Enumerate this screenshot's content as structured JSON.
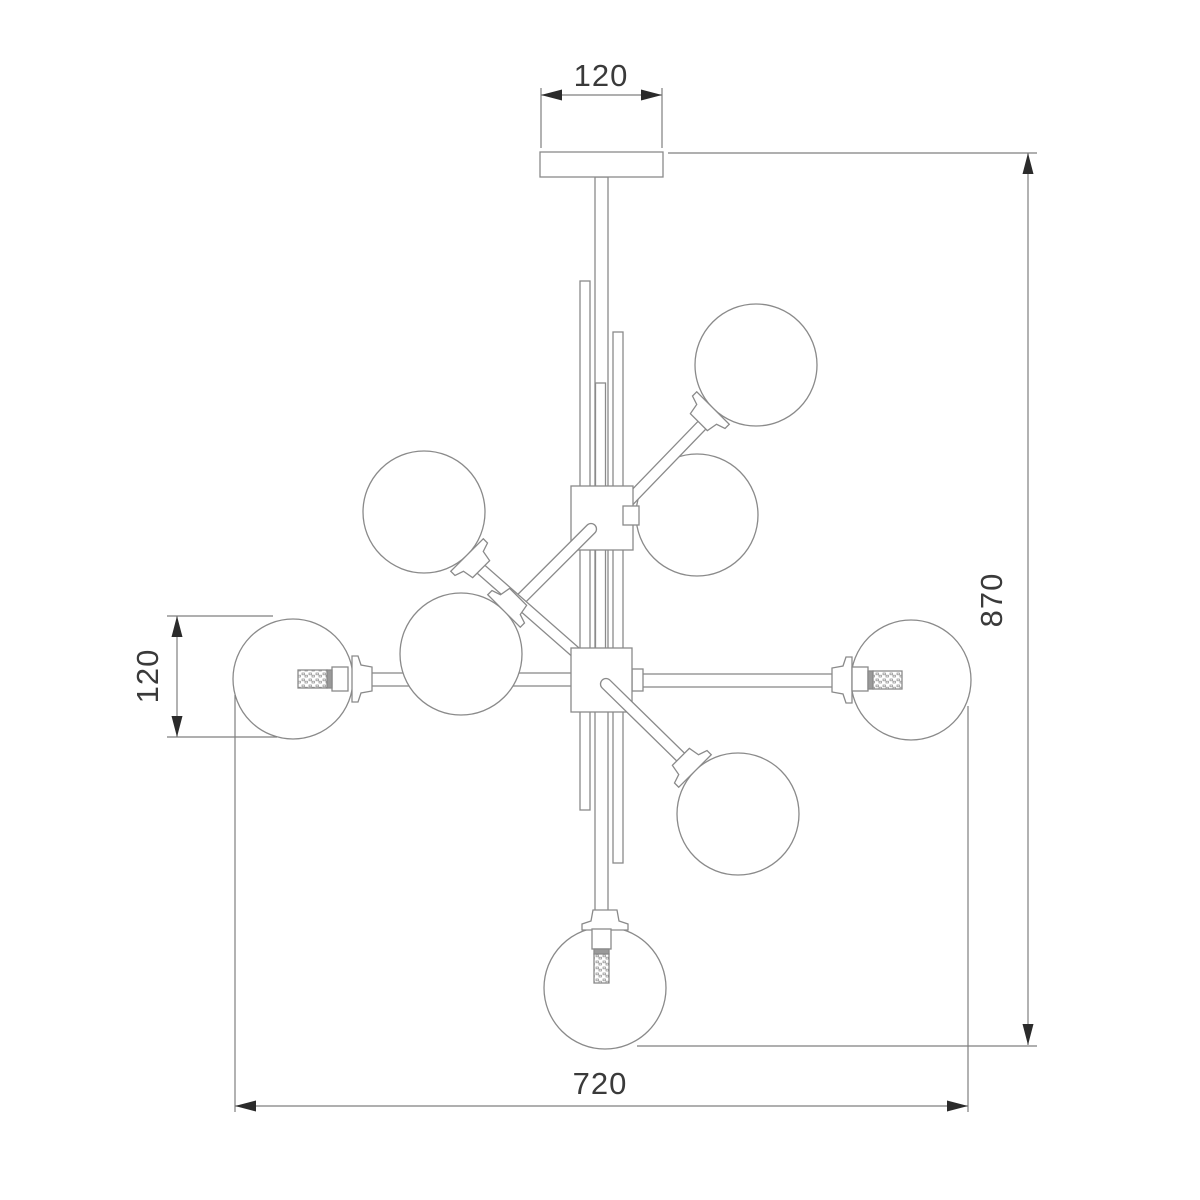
{
  "drawing": {
    "title": "chandelier-technical-drawing",
    "subject": "8-light sputnik chandelier, front elevation line drawing",
    "globe_count": 8,
    "line_color": "#8a8a8a",
    "dimension_line_color": "#7f7f7f",
    "arrow_color": "#2b2b2b",
    "text_color": "#3a3a3a",
    "background": "#ffffff"
  },
  "dimensions": {
    "canopy_width": {
      "value": "120",
      "orientation": "horizontal",
      "location": "top"
    },
    "globe_diameter": {
      "value": "120",
      "orientation": "vertical",
      "location": "left"
    },
    "overall_height": {
      "value": "870",
      "orientation": "vertical",
      "location": "right"
    },
    "overall_width": {
      "value": "720",
      "orientation": "horizontal",
      "location": "bottom"
    }
  }
}
